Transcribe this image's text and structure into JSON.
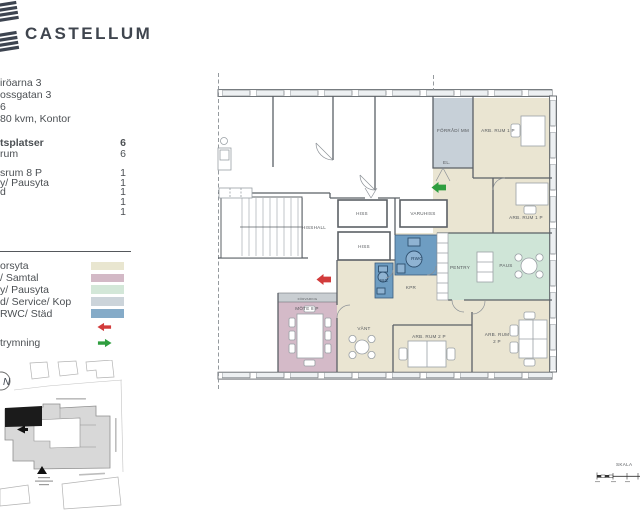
{
  "header": {
    "brand": "CASTELLUM"
  },
  "property": {
    "line1": "iröarna 3",
    "line2": "ossgatan 3",
    "line3": "6",
    "line4": "80 kvm, Kontor"
  },
  "stats": {
    "rows": [
      {
        "label": "tsplatser",
        "value": "6"
      },
      {
        "label": "rum",
        "value": "6"
      },
      {
        "label": "srum 8 P",
        "value": "1"
      },
      {
        "label": "y/ Pausyta",
        "value": "1"
      },
      {
        "label": "d",
        "value": "1"
      },
      {
        "label": "",
        "value": "1"
      },
      {
        "label": "",
        "value": "1"
      }
    ]
  },
  "legend": {
    "items": [
      {
        "label": "orsyta",
        "color": "#e9e6d0"
      },
      {
        "label": "/ Samtal",
        "color": "#d3b9c6"
      },
      {
        "label": "y/ Pausyta",
        "color": "#d3e7d8"
      },
      {
        "label": "d/ Service/ Kop",
        "color": "#ccd4da"
      },
      {
        "label": "RWC/ Städ",
        "color": "#85abc8"
      }
    ],
    "exit_red_color": "#d23b3b",
    "exit_green_label": "trymning",
    "exit_green_color": "#2f9e3f"
  },
  "sitemap": {
    "compass": "N"
  },
  "floorplan": {
    "labels": {
      "hisshall": "HISSHALL",
      "hiss1": "HISS",
      "hiss2": "HISS",
      "varuhiss": "VARUHISS",
      "forrad": "FÖRRÅD/ MM",
      "el": "EL.",
      "arbrum1a": "ARB. RUM 1 P",
      "arbrum1b": "ARB. RUM 1 P",
      "rwc": "RWC",
      "wc": "WC",
      "kpr": "KPR",
      "pentry": "PENTRY",
      "paus": "PAUS",
      "vant": "VÄNT",
      "arbrum2a": "ARB. RUM 2 P",
      "arbrum2b_line1": "ARB. RUM",
      "arbrum2b_line2": "2 P",
      "mote": "MÖTE 8 P",
      "forvaring": "FÖRVARING"
    },
    "colors": {
      "office": "#eae5d2",
      "meeting": "#d4bac8",
      "pause": "#cfe5d7",
      "service": "#c7d0d8",
      "wc": "#6e9dc2"
    }
  },
  "scalebar": {
    "label": "SKALA"
  }
}
